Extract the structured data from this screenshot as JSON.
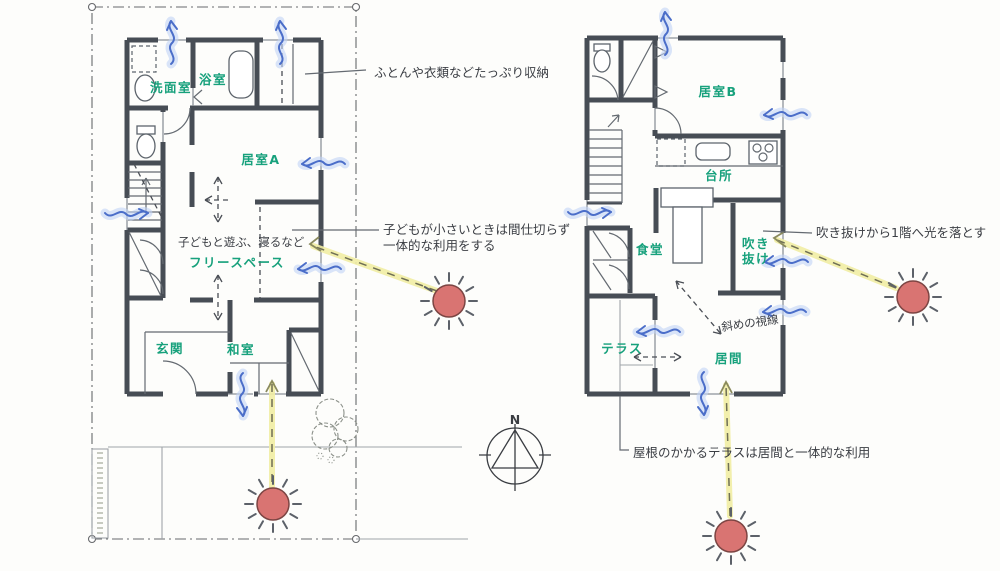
{
  "floor1": {
    "rooms": {
      "washroom": "洗面室",
      "bath": "浴室",
      "room_a": "居室A",
      "free_space": "フリースペース",
      "entrance": "玄関",
      "tatami": "和室"
    },
    "note": "子どもと遊ぶ、寝るなど"
  },
  "floor2": {
    "rooms": {
      "room_b": "居室B",
      "kitchen": "台所",
      "dining": "食堂",
      "atrium_line1": "吹き",
      "atrium_line2": "抜け",
      "terrace": "テラス",
      "living": "居間"
    },
    "note": "斜めの視線"
  },
  "annotations": {
    "storage": "ふとんや衣類などたっぷり収納",
    "partition_line1": "子どもが小さいときは間仕切らず",
    "partition_line2": "一体的な利用をする",
    "light": "吹き抜けから1階へ光を落とす",
    "terrace": "屋根のかかるテラスは居間と一体的な利用"
  },
  "compass": {
    "north_label": "N"
  },
  "colors": {
    "wall": "#474d55",
    "room_label": "#17a17c",
    "annotation": "#3b3e44",
    "breeze": "#4b6ec9",
    "breeze_glow": "#c2d3f6",
    "sun_fill": "#d97472",
    "sun_outline": "#7c4543",
    "light_ray": "#f1eda3",
    "boundary": "#67696c"
  }
}
